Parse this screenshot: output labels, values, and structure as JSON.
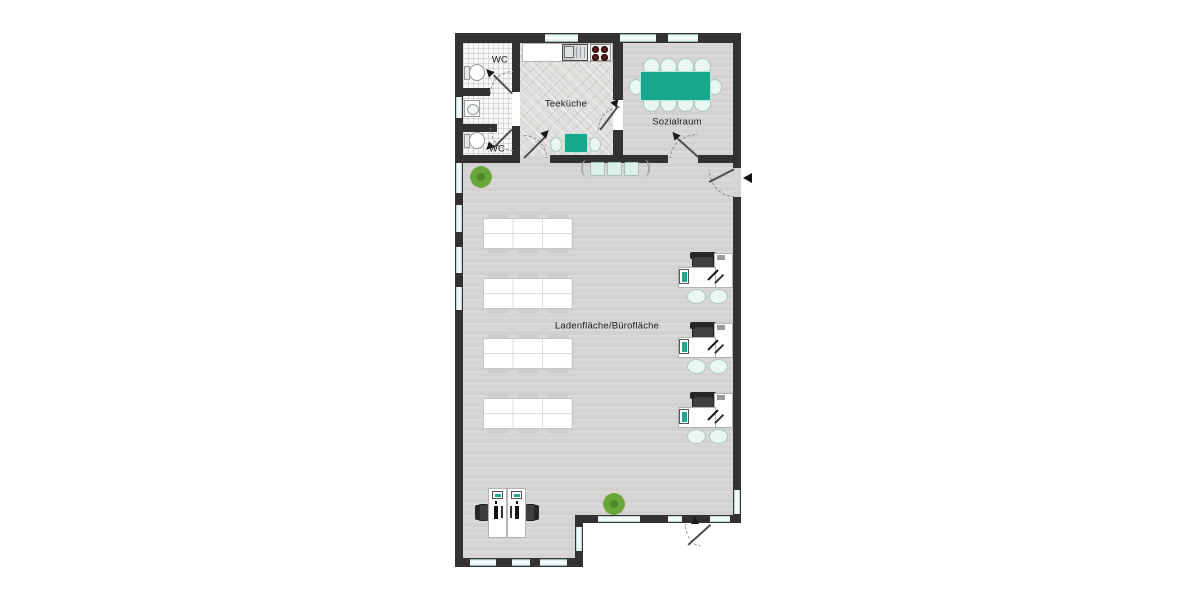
{
  "rooms": [
    {
      "id": "wc-top",
      "label": "WC"
    },
    {
      "id": "wc-bottom",
      "label": "WC"
    },
    {
      "id": "teekueche",
      "label": "Teeküche"
    },
    {
      "id": "sozialraum",
      "label": "Sozialraum"
    },
    {
      "id": "hauptraum",
      "label": "Ladenfläche/Bürofläche"
    }
  ],
  "furniture_counts": {
    "sozialraum_table_seats": 10,
    "teekueche_table_seats": 2,
    "display_tables": 4,
    "office_desks_right": 3,
    "reception_workstations": 2,
    "toilets": 2,
    "wash_basins": 1,
    "plants": 2,
    "bench_seats": 3
  },
  "colors": {
    "wall": "#333230",
    "accent_teal": "#18a88b",
    "floor_main": "#d6d5d3",
    "window": "#e9f5f4",
    "plant_green": "#79b348",
    "chair_mint": "#e9f6f2",
    "stove_burner": "#5a1e1c"
  }
}
